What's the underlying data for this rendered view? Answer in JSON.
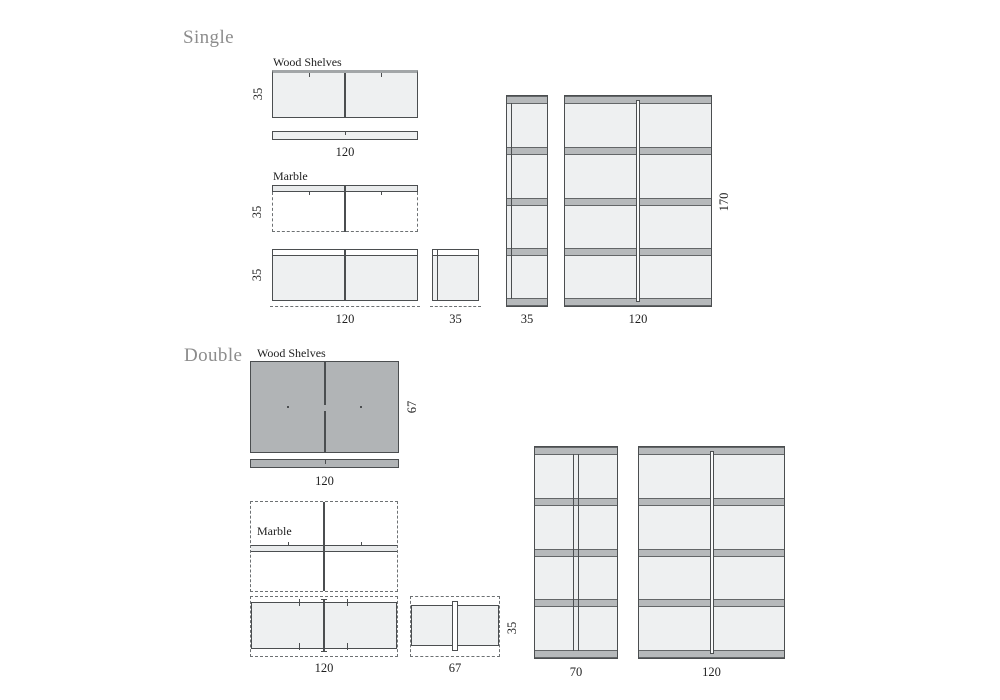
{
  "colors": {
    "line": "#4b4e50",
    "line_soft": "#6d7173",
    "fill_light": "#eef0f1",
    "fill_medium": "#b1b4b6",
    "band": "#b6b9bb",
    "band_edge": "#636668",
    "marble_bar": "#e9ebec",
    "top_edge": "#a2a6a8",
    "title_gray": "#8c8c8c",
    "text": "#1f1f1f"
  },
  "single": {
    "title": "Single",
    "wood": {
      "label": "Wood Shelves",
      "depth": "35",
      "width": "120"
    },
    "marble": {
      "label": "Marble",
      "depth": "35",
      "front_height": "35",
      "width": "120",
      "side_width": "35"
    },
    "tall": {
      "narrow_width": "35",
      "wide_width": "120",
      "height": "170"
    }
  },
  "double": {
    "title": "Double",
    "wood": {
      "label": "Wood Shelves",
      "depth": "67",
      "width": "120"
    },
    "marble": {
      "label": "Marble",
      "width": "120",
      "side_width": "67",
      "side_height": "35"
    },
    "tall": {
      "narrow_width": "70",
      "wide_width": "120"
    }
  }
}
